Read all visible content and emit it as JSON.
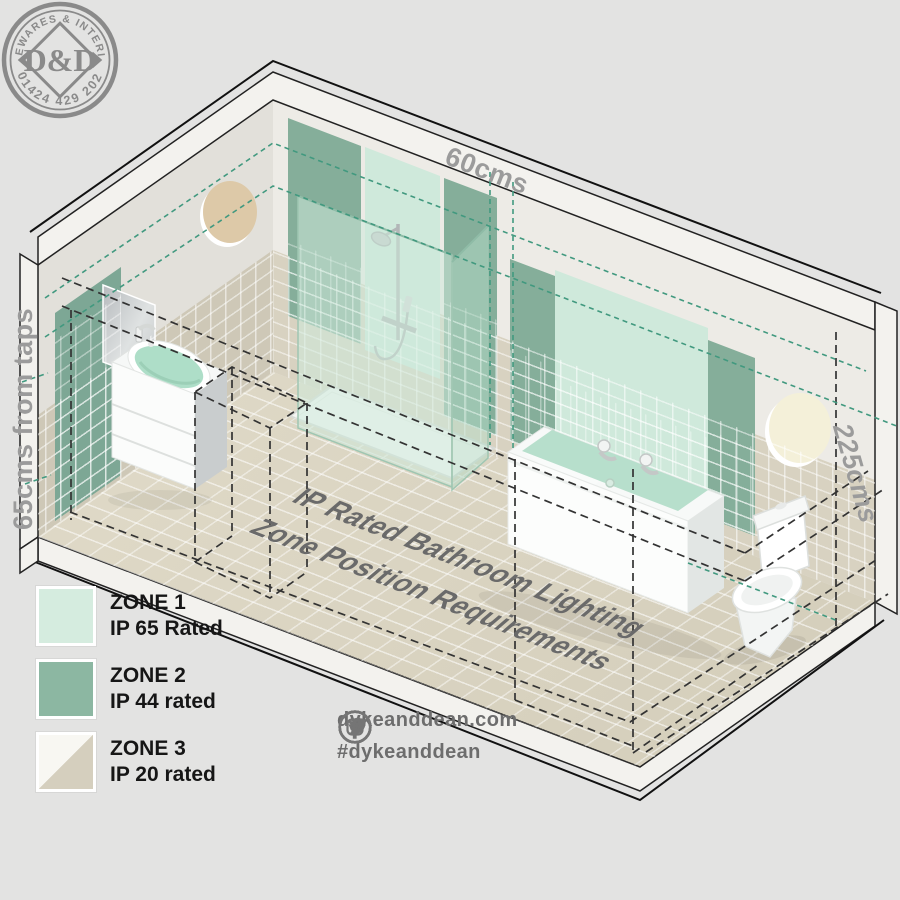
{
  "title_text": {
    "line1": "IP Rated Bathroom Lighting",
    "line2": "Zone Position Requirements"
  },
  "dimensions": {
    "shower_zone_width": "60cms",
    "basin_zone_distance": "65cms from taps",
    "zone_height": "225cms"
  },
  "legend": {
    "zones": [
      {
        "name": "ZONE 1",
        "rating": "IP 65 Rated",
        "color": "#d5ecdf"
      },
      {
        "name": "ZONE 2",
        "rating": "IP 44 rated",
        "color": "#8cb7a2"
      },
      {
        "name": "ZONE 3",
        "rating": "IP 20 rated",
        "colors": [
          "#f8f7f2",
          "#d5cfbe"
        ]
      }
    ]
  },
  "logo": {
    "arc_top": "HOMEWARES & INTERIORS",
    "monogram": "D&D",
    "phone": "01424 429 202"
  },
  "social": {
    "website": "dykeanddean.com",
    "hashtag": "#dykeanddean",
    "icons": [
      "instagram-icon",
      "twitter-icon",
      "facebook-icon",
      "pinterest-icon"
    ]
  },
  "colors": {
    "background": "#e3e3e2",
    "zone1_mint": "#cfe9db",
    "zone2_green": "#85ae9a",
    "zone3_tile_beige": "#d8d2c1",
    "floor_beige": "#dcd6c4",
    "concrete": "#edebe6",
    "dashed_black": "#333333",
    "dashed_teal": "#41997f",
    "label_gray": "#9b9b9b",
    "logo_gray": "#8a8a8a"
  }
}
